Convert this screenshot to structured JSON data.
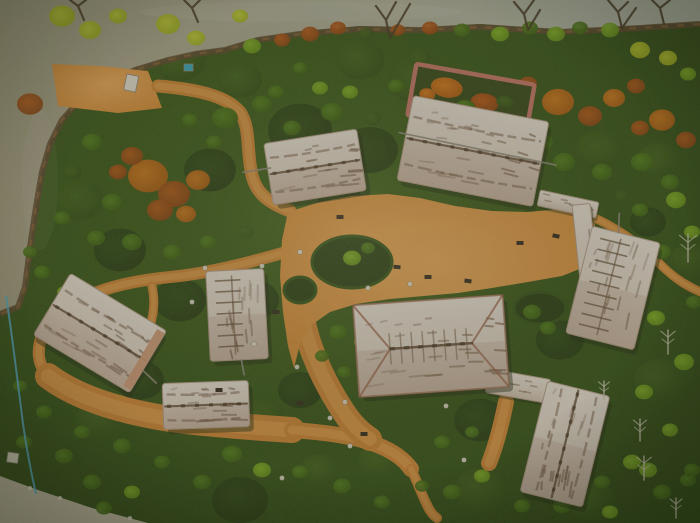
{
  "scene": {
    "description": "aerial-drone-view-of-thatched-heritage-village-park",
    "width": 700,
    "height": 523,
    "palette": {
      "grass_center": "#3a5a1b",
      "grass_edge": "#223d0e",
      "water_left": "#a49f88",
      "water_right": "#b6bdb3",
      "shore": "#53402a",
      "path": "#c9853a",
      "path_core": "#e0a156",
      "court_center": "#e8ab62",
      "court_edge": "#d08a3a",
      "roof_light": "#f2ece5",
      "roof_mid": "#e6dcd2",
      "roof_dark": "#d3c4b7",
      "roof_streak": "#6b5140",
      "ridge": "#55402f",
      "hip_edge": "#96614c",
      "wall_pink": "#c0766a",
      "end_cap": "#cf9c7c",
      "road": "#c6c0af",
      "pipe_blue": "#56aecb",
      "tree_colors": [
        [
          "#223c10",
          "#15280a"
        ],
        [
          "#3c5c1c",
          "#27430f"
        ],
        [
          "#4f7d1f",
          "#33550f"
        ],
        [
          "#86b52e",
          "#5d8a1a"
        ],
        [
          "#c3cf3e",
          "#9aad20"
        ],
        [
          "#cd7a22",
          "#a35410"
        ],
        [
          "#ad5517",
          "#7e3a0c"
        ],
        [
          "#6f9a40",
          "#4c6e26"
        ]
      ]
    },
    "water": {
      "d": "M0,0 L700,0 700,22 640,26 560,30 480,24 420,28 360,26 300,32 258,38 225,48 195,52 168,58 135,68 105,82 80,98 62,118 50,142 42,170 36,205 30,245 25,285 18,305 0,312 Z"
    },
    "shore": {
      "d": "M700,24 L640,28 560,32 480,27 420,30 360,29 300,34 258,40 225,50 195,54 168,60 135,70 105,84 80,100 62,120 50,144 42,172 36,207 30,247 25,287 18,307 0,314"
    },
    "clearing": {
      "d": "M52,64 L100,66 148,71 162,108 118,113 58,106 Z"
    },
    "courtyard": {
      "d": "M288,212 L320,202 352,196 388,194 420,198 455,206 492,211 528,212 560,209 584,213 595,224 593,248 587,266 562,276 528,282 492,288 458,293 424,296 390,299 356,304 330,312 310,326 300,344 294,368 288,346 283,312 280,276 282,240 Z"
    },
    "paths": [
      {
        "d": "M158,86 C205,90 228,98 240,112 C250,126 247,150 251,170 C254,190 264,201 290,211",
        "w": 13
      },
      {
        "d": "M286,252 C245,264 205,274 170,277 C132,281 108,287 88,296 C66,306 50,320 42,336 C36,352 38,366 50,378",
        "w": 12
      },
      {
        "d": "M48,376 C80,400 130,414 185,421 C230,426 262,428 292,430",
        "w": 26
      },
      {
        "d": "M292,430 C322,432 352,436 372,443 C392,450 404,459 411,469",
        "w": 16
      },
      {
        "d": "M411,469 C417,481 421,493 427,505 C430,512 434,516 437,518",
        "w": 10
      },
      {
        "d": "M293,260 C299,300 303,330 315,358 C323,378 333,396 345,414 C353,426 361,433 370,439",
        "w": 24
      },
      {
        "d": "M152,286 C157,308 151,330 139,350 C133,360 127,368 119,374",
        "w": 9
      },
      {
        "d": "M597,219 C622,231 643,247 661,265 C677,281 691,288 703,293",
        "w": 9
      },
      {
        "d": "M506,402 C501,426 496,446 489,463",
        "w": 16
      }
    ],
    "islands": [
      [
        352,
        262,
        40,
        26
      ],
      [
        300,
        290,
        16,
        13
      ],
      [
        540,
        308,
        26,
        16
      ]
    ],
    "road": {
      "d": "M0,476 L38,490 92,508 148,523 0,523 Z",
      "dots": [
        [
          30,
          488
        ],
        [
          60,
          498
        ],
        [
          100,
          510
        ],
        [
          130,
          518
        ]
      ]
    },
    "pipe": {
      "d": "M6,296 C10,320 14,352 20,400 C24,436 30,468 36,494"
    },
    "patches": [
      [
        300,
        130,
        32,
        0
      ],
      [
        210,
        170,
        26,
        0
      ],
      [
        370,
        150,
        28,
        0
      ],
      [
        120,
        250,
        26,
        0
      ],
      [
        180,
        300,
        26,
        0
      ],
      [
        255,
        300,
        24,
        0
      ],
      [
        140,
        380,
        24,
        0
      ],
      [
        300,
        390,
        22,
        0
      ],
      [
        480,
        420,
        26,
        0
      ],
      [
        560,
        340,
        24,
        0
      ],
      [
        240,
        500,
        28,
        0
      ],
      [
        648,
        222,
        18,
        0
      ],
      [
        340,
        200,
        22,
        0
      ],
      [
        420,
        80,
        30,
        1
      ],
      [
        180,
        60,
        26,
        1
      ],
      [
        520,
        140,
        26,
        1
      ],
      [
        600,
        150,
        24,
        1
      ],
      [
        660,
        160,
        22,
        1
      ],
      [
        80,
        200,
        24,
        1
      ],
      [
        460,
        160,
        24,
        1
      ],
      [
        260,
        420,
        26,
        1
      ],
      [
        480,
        490,
        26,
        1
      ],
      [
        590,
        500,
        24,
        1
      ],
      [
        660,
        380,
        26,
        1
      ],
      [
        690,
        260,
        20,
        1
      ],
      [
        360,
        60,
        24,
        1
      ],
      [
        240,
        80,
        22,
        1
      ],
      [
        60,
        330,
        22,
        1
      ],
      [
        100,
        420,
        24,
        1
      ],
      [
        600,
        320,
        20,
        1
      ],
      [
        380,
        460,
        22,
        1
      ],
      [
        320,
        470,
        20,
        1
      ]
    ],
    "trees": [
      [
        148,
        176,
        20,
        5
      ],
      [
        174,
        194,
        16,
        6
      ],
      [
        198,
        180,
        12,
        5
      ],
      [
        132,
        156,
        11,
        6
      ],
      [
        160,
        210,
        13,
        6
      ],
      [
        186,
        214,
        10,
        5
      ],
      [
        118,
        172,
        9,
        6
      ],
      [
        30,
        104,
        13,
        6
      ],
      [
        558,
        102,
        16,
        5
      ],
      [
        590,
        116,
        12,
        6
      ],
      [
        614,
        98,
        11,
        5
      ],
      [
        636,
        86,
        9,
        6
      ],
      [
        662,
        120,
        13,
        5
      ],
      [
        686,
        140,
        10,
        6
      ],
      [
        640,
        128,
        9,
        6
      ],
      [
        528,
        84,
        9,
        6
      ],
      [
        62,
        16,
        13,
        4
      ],
      [
        90,
        30,
        11,
        4
      ],
      [
        118,
        16,
        9,
        4
      ],
      [
        168,
        24,
        12,
        4
      ],
      [
        196,
        38,
        9,
        4
      ],
      [
        240,
        16,
        8,
        4
      ],
      [
        252,
        46,
        9,
        3
      ],
      [
        282,
        40,
        8,
        6
      ],
      [
        310,
        34,
        9,
        6
      ],
      [
        338,
        28,
        8,
        6
      ],
      [
        366,
        34,
        8,
        1
      ],
      [
        398,
        30,
        7,
        6
      ],
      [
        430,
        28,
        8,
        6
      ],
      [
        462,
        30,
        8,
        2
      ],
      [
        500,
        34,
        9,
        3
      ],
      [
        530,
        28,
        8,
        2
      ],
      [
        556,
        34,
        9,
        3
      ],
      [
        580,
        28,
        8,
        2
      ],
      [
        610,
        30,
        9,
        3
      ],
      [
        640,
        50,
        10,
        4
      ],
      [
        668,
        58,
        9,
        4
      ],
      [
        688,
        74,
        8,
        3
      ],
      [
        676,
        200,
        10,
        3
      ],
      [
        692,
        232,
        8,
        3
      ],
      [
        656,
        318,
        9,
        3
      ],
      [
        684,
        362,
        10,
        3
      ],
      [
        644,
        392,
        9,
        3
      ],
      [
        670,
        430,
        8,
        3
      ],
      [
        610,
        512,
        8,
        3
      ],
      [
        648,
        470,
        9,
        3
      ],
      [
        688,
        480,
        8,
        2
      ],
      [
        225,
        118,
        13,
        2
      ],
      [
        262,
        104,
        10,
        2
      ],
      [
        292,
        128,
        9,
        2
      ],
      [
        332,
        112,
        11,
        2
      ],
      [
        372,
        118,
        9,
        1
      ],
      [
        420,
        58,
        10,
        1
      ],
      [
        396,
        86,
        8,
        2
      ],
      [
        350,
        92,
        8,
        3
      ],
      [
        320,
        88,
        8,
        3
      ],
      [
        564,
        162,
        11,
        2
      ],
      [
        602,
        172,
        10,
        2
      ],
      [
        642,
        162,
        11,
        2
      ],
      [
        670,
        182,
        9,
        2
      ],
      [
        544,
        142,
        9,
        2
      ],
      [
        522,
        166,
        8,
        2
      ],
      [
        92,
        142,
        10,
        2
      ],
      [
        72,
        172,
        9,
        1
      ],
      [
        112,
        202,
        10,
        2
      ],
      [
        62,
        218,
        8,
        2
      ],
      [
        96,
        238,
        9,
        2
      ],
      [
        132,
        242,
        10,
        2
      ],
      [
        172,
        252,
        9,
        2
      ],
      [
        208,
        242,
        8,
        2
      ],
      [
        246,
        232,
        8,
        1
      ],
      [
        336,
        162,
        9,
        2
      ],
      [
        304,
        178,
        8,
        2
      ],
      [
        276,
        92,
        8,
        2
      ],
      [
        300,
        68,
        7,
        2
      ],
      [
        190,
        120,
        8,
        2
      ],
      [
        214,
        142,
        8,
        2
      ],
      [
        352,
        258,
        9,
        3
      ],
      [
        368,
        248,
        7,
        2
      ],
      [
        338,
        332,
        9,
        2
      ],
      [
        362,
        342,
        8,
        3
      ],
      [
        322,
        356,
        7,
        2
      ],
      [
        344,
        372,
        7,
        2
      ],
      [
        532,
        312,
        9,
        2
      ],
      [
        548,
        328,
        8,
        2
      ],
      [
        232,
        454,
        10,
        2
      ],
      [
        262,
        470,
        9,
        3
      ],
      [
        300,
        472,
        8,
        2
      ],
      [
        202,
        482,
        9,
        2
      ],
      [
        162,
        462,
        8,
        2
      ],
      [
        122,
        446,
        9,
        2
      ],
      [
        82,
        432,
        8,
        2
      ],
      [
        342,
        486,
        9,
        2
      ],
      [
        382,
        502,
        8,
        2
      ],
      [
        452,
        492,
        9,
        2
      ],
      [
        482,
        476,
        8,
        3
      ],
      [
        522,
        506,
        8,
        2
      ],
      [
        562,
        506,
        9,
        2
      ],
      [
        602,
        482,
        8,
        2
      ],
      [
        632,
        462,
        9,
        3
      ],
      [
        662,
        492,
        9,
        2
      ],
      [
        692,
        470,
        8,
        2
      ],
      [
        422,
        486,
        7,
        2
      ],
      [
        662,
        252,
        9,
        2
      ],
      [
        694,
        302,
        8,
        2
      ],
      [
        652,
        282,
        7,
        1
      ],
      [
        640,
        210,
        8,
        2
      ],
      [
        622,
        196,
        7,
        1
      ],
      [
        42,
        272,
        8,
        2
      ],
      [
        30,
        252,
        7,
        2
      ],
      [
        64,
        292,
        7,
        3
      ],
      [
        20,
        386,
        7,
        2
      ],
      [
        44,
        412,
        8,
        2
      ],
      [
        64,
        456,
        9,
        2
      ],
      [
        24,
        442,
        8,
        2
      ],
      [
        92,
        482,
        9,
        2
      ],
      [
        132,
        492,
        8,
        3
      ],
      [
        104,
        508,
        8,
        2
      ],
      [
        442,
        442,
        8,
        2
      ],
      [
        472,
        432,
        7,
        2
      ]
    ],
    "enclosure": {
      "cx": 471,
      "cy": 100,
      "w": 120,
      "h": 52,
      "rot": 10,
      "shrubs": [
        [
          -26,
          -8,
          16,
          10,
          5
        ],
        [
          14,
          0,
          14,
          9,
          6
        ],
        [
          -4,
          8,
          10,
          7,
          2
        ],
        [
          34,
          -4,
          9,
          6,
          1
        ],
        [
          -44,
          2,
          8,
          6,
          5
        ]
      ]
    },
    "corridors": [
      {
        "cx": 568,
        "cy": 204,
        "w": 60,
        "h": 16,
        "rot": 12
      },
      {
        "cx": 588,
        "cy": 270,
        "w": 18,
        "h": 132,
        "rot": -6
      },
      {
        "cx": 518,
        "cy": 386,
        "w": 62,
        "h": 24,
        "rot": 10
      }
    ],
    "buildings": [
      {
        "cx": 315,
        "cy": 167,
        "w": 94,
        "h": 62,
        "rot": -9,
        "kind": "barrel-h",
        "pole": [
          -72,
          -6,
          -44,
          -6
        ]
      },
      {
        "cx": 473,
        "cy": 151,
        "w": 138,
        "h": 86,
        "rot": 11,
        "kind": "barrel-h",
        "pole": [
          -76,
          -4,
          84,
          -2
        ]
      },
      {
        "cx": 613,
        "cy": 288,
        "w": 70,
        "h": 110,
        "rot": 14,
        "kind": "ladder-v",
        "pole": [
          -8,
          -55,
          -12,
          -74
        ]
      },
      {
        "cx": 431,
        "cy": 346,
        "w": 150,
        "h": 92,
        "rot": -4,
        "kind": "hip"
      },
      {
        "cx": 565,
        "cy": 444,
        "w": 64,
        "h": 114,
        "rot": 14,
        "kind": "barrel-v"
      },
      {
        "cx": 100,
        "cy": 333,
        "w": 112,
        "h": 72,
        "rot": 31,
        "kind": "barrel-h",
        "cap": 1,
        "pole": [
          56,
          10,
          74,
          14
        ]
      },
      {
        "cx": 237,
        "cy": 315,
        "w": 58,
        "h": 90,
        "rot": -3,
        "kind": "ladder-v",
        "pole": [
          2,
          45,
          4,
          60
        ]
      },
      {
        "cx": 206,
        "cy": 405,
        "w": 86,
        "h": 46,
        "rot": -2,
        "kind": "barrel-h"
      }
    ],
    "bare_trees": [
      "M390,38 L386,20 L376,6 M386,20 L396,2 M390,38 L403,16 L410,4",
      "M528,30 L524,14 L514,2 M524,14 L534,0 M528,30 L540,10",
      "M622,28 L618,12 L608,0 M618,12 L628,2 M622,28 L636,8",
      "M198,22 L192,8 L184,0 M192,8 L200,0",
      "M84,20 L78,6 L70,0 M78,6 L86,0",
      "M664,24 L660,8 L652,0 M660,8 L670,0"
    ],
    "dead_trees": [
      [
        688,
        248,
        14
      ],
      [
        668,
        342,
        12
      ],
      [
        644,
        468,
        12
      ],
      [
        676,
        508,
        10
      ],
      [
        640,
        430,
        11
      ],
      [
        604,
        390,
        9
      ]
    ],
    "dots": [
      [
        205,
        268
      ],
      [
        262,
        266
      ],
      [
        300,
        252
      ],
      [
        297,
        367
      ],
      [
        345,
        402
      ],
      [
        350,
        446
      ],
      [
        368,
        288
      ],
      [
        410,
        284
      ],
      [
        446,
        406
      ],
      [
        330,
        418
      ],
      [
        192,
        302
      ],
      [
        282,
        478
      ],
      [
        464,
        460
      ],
      [
        254,
        344
      ]
    ],
    "benches": [
      [
        397,
        267,
        5
      ],
      [
        428,
        277,
        0
      ],
      [
        468,
        281,
        8
      ],
      [
        340,
        217,
        0
      ],
      [
        276,
        312,
        0
      ],
      [
        300,
        403,
        10
      ],
      [
        219,
        390,
        0
      ],
      [
        520,
        243,
        0
      ],
      [
        556,
        236,
        12
      ],
      [
        364,
        434,
        0
      ]
    ],
    "objects": [
      {
        "name": "clearing-sign",
        "x": 127,
        "y": 74,
        "w": 12,
        "h": 16,
        "rot": 12,
        "fill": "#eae6dc"
      },
      {
        "name": "teal-box",
        "x": 184,
        "y": 64,
        "w": 9,
        "h": 7,
        "rot": 0,
        "fill": "#3aa8c0"
      },
      {
        "name": "white-box",
        "x": 8,
        "y": 452,
        "w": 11,
        "h": 10,
        "rot": 8,
        "fill": "#ddd8c8"
      }
    ]
  }
}
